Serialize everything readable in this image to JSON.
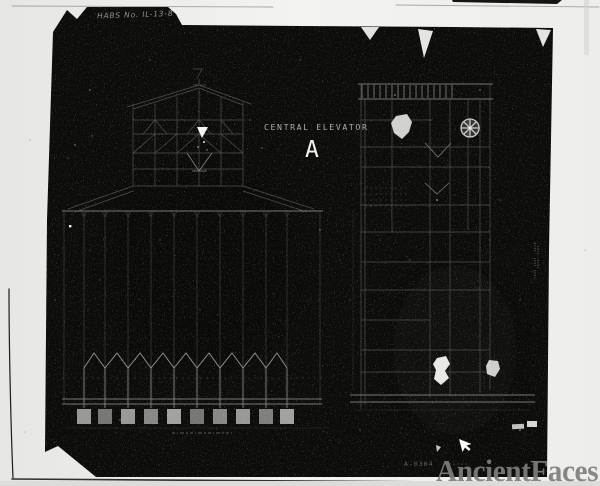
{
  "scan": {
    "habs_label": "HABS No. IL-13-8",
    "plate_number": "A-0304"
  },
  "drawing": {
    "title": "CENTRAL ELEVATOR",
    "designation": "A"
  },
  "watermark": {
    "text": "AncientFaces"
  },
  "colors": {
    "background": "#efefed",
    "photo": "#0c0c0b",
    "faint_line": "#51514f",
    "mid_line": "#7b7b79",
    "bright_line": "#9c9c9a",
    "highlight": "#f2f2f0",
    "title_text": "#aeaeac",
    "habs_text": "#92928c",
    "plate_text": "#64635e",
    "watermark": "#807f79"
  }
}
